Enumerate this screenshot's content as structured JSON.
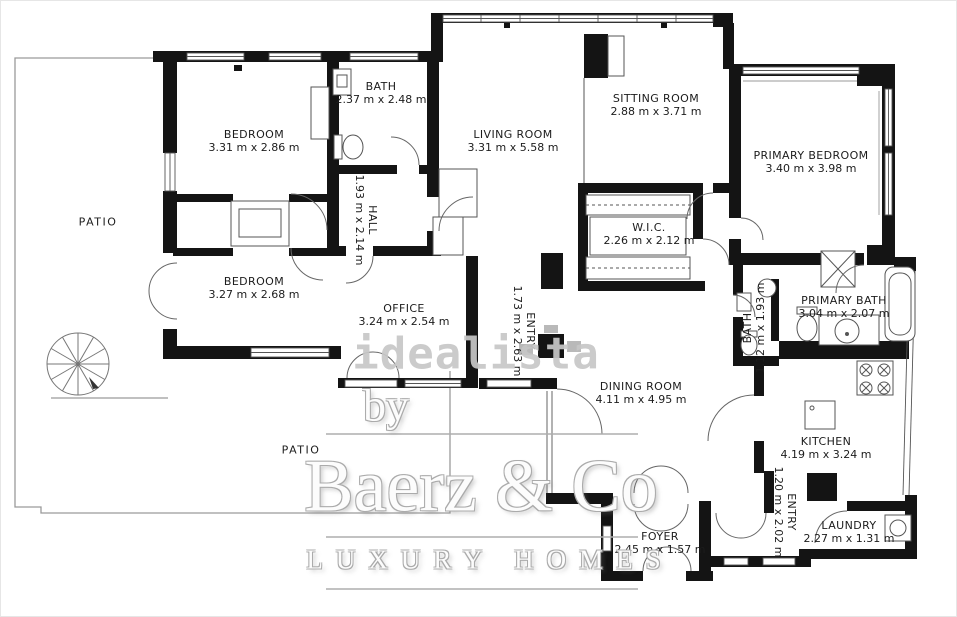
{
  "watermarks": {
    "portal": "idealista",
    "by": "by",
    "brand": "Baerz & Co",
    "tagline": "LUXURY HOMES"
  },
  "colors": {
    "wall": "#141414",
    "label_text": "#1c1c1c",
    "watermark_gray": "#c7c7c7",
    "engraved_outline": "#ababab"
  },
  "rooms": [
    {
      "name": "BEDROOM",
      "dims": "3.31 m x 2.86 m"
    },
    {
      "name": "BATH",
      "dims": "2.37 m x 2.48 m"
    },
    {
      "name": "LIVING ROOM",
      "dims": "3.31 m x 5.58 m"
    },
    {
      "name": "SITTING ROOM",
      "dims": "2.88 m x 3.71 m"
    },
    {
      "name": "PRIMARY BEDROOM",
      "dims": "3.40 m x 3.98 m"
    },
    {
      "name": "HALL",
      "dims": "1.93 m x 2.14 m"
    },
    {
      "name": "W.I.C.",
      "dims": "2.26 m x 2.12 m"
    },
    {
      "name": "BEDROOM",
      "dims": "3.27 m x 2.68 m"
    },
    {
      "name": "OFFICE",
      "dims": "3.24 m x 2.54 m"
    },
    {
      "name": "ENTRY",
      "dims": "1.73 m x 2.63 m"
    },
    {
      "name": "BATH",
      "dims": "1.12 m x 1.93 m"
    },
    {
      "name": "PRIMARY BATH",
      "dims": "3.04 m x 2.07 m"
    },
    {
      "name": "DINING ROOM",
      "dims": "4.11 m x 4.95 m"
    },
    {
      "name": "KITCHEN",
      "dims": "4.19 m x 3.24 m"
    },
    {
      "name": "ENTRY",
      "dims": "1.20 m x 2.02 m"
    },
    {
      "name": "LAUNDRY",
      "dims": "2.27 m x 1.31 m"
    },
    {
      "name": "FOYER",
      "dims": "2.45 m x 1.57 m"
    },
    {
      "name": "PATIO",
      "dims": ""
    },
    {
      "name": "PATIO",
      "dims": ""
    }
  ]
}
